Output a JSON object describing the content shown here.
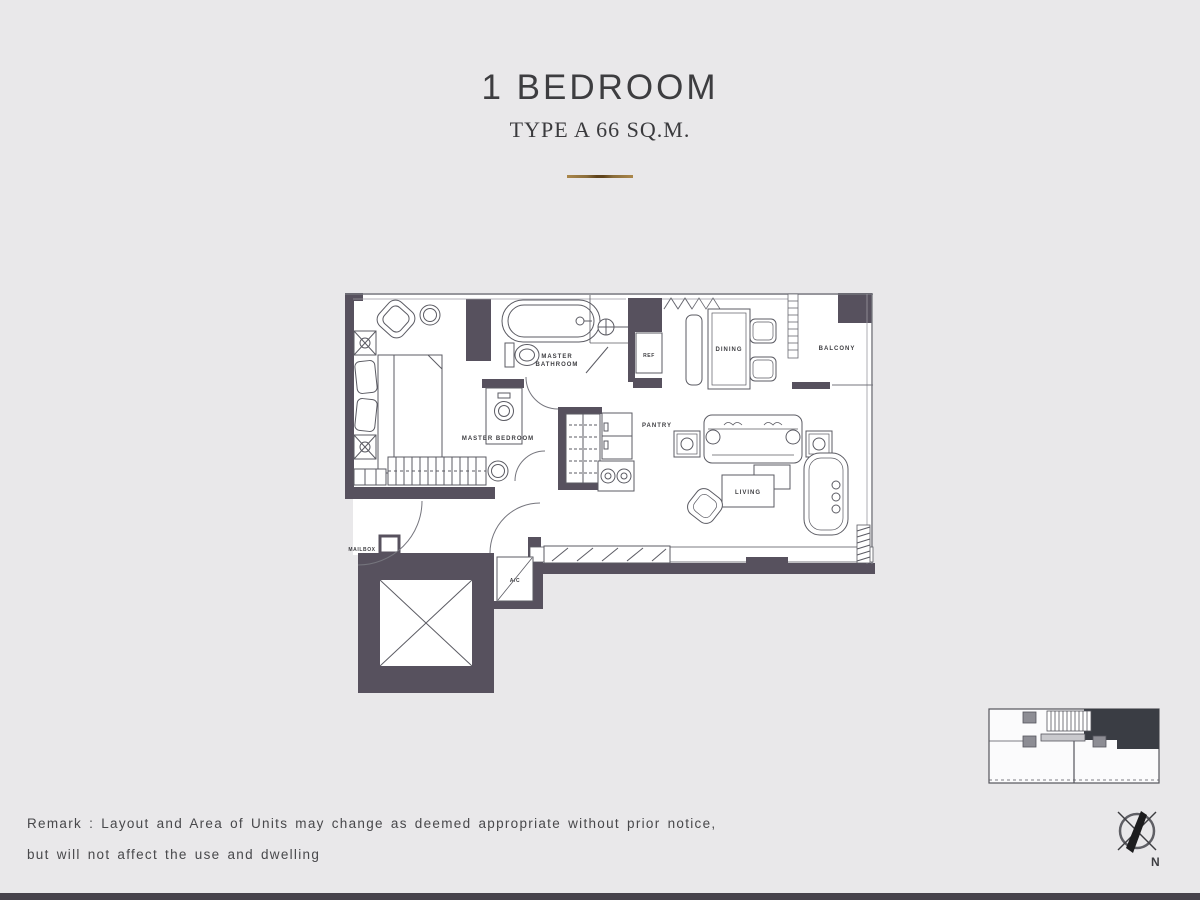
{
  "header": {
    "title": "1 BEDROOM",
    "subtitle": "TYPE A 66 SQ.M."
  },
  "plan": {
    "labels": {
      "master_bathroom_line1": "MASTER",
      "master_bathroom_line2": "BATHROOM",
      "master_bedroom": "MASTER BEDROOM",
      "ref": "REF",
      "dining": "DINING",
      "balcony": "BALCONY",
      "pantry": "PANTRY",
      "living": "LIVING",
      "mailbox": "MAILBOX",
      "ac": "A/C"
    }
  },
  "remark": {
    "line1": "Remark : Layout and Area of Units may change as deemed appropriate without prior notice,",
    "line2": "but will not affect the use and dwelling"
  },
  "compass": {
    "north": "N"
  },
  "colors": {
    "background": "#e9e8ea",
    "wall": "#57515e",
    "furniture_line": "#5b5b63",
    "accent_gold": "#8a6d3b",
    "keyplan_unit_fill": "#3a3d44",
    "text": "#414144"
  }
}
